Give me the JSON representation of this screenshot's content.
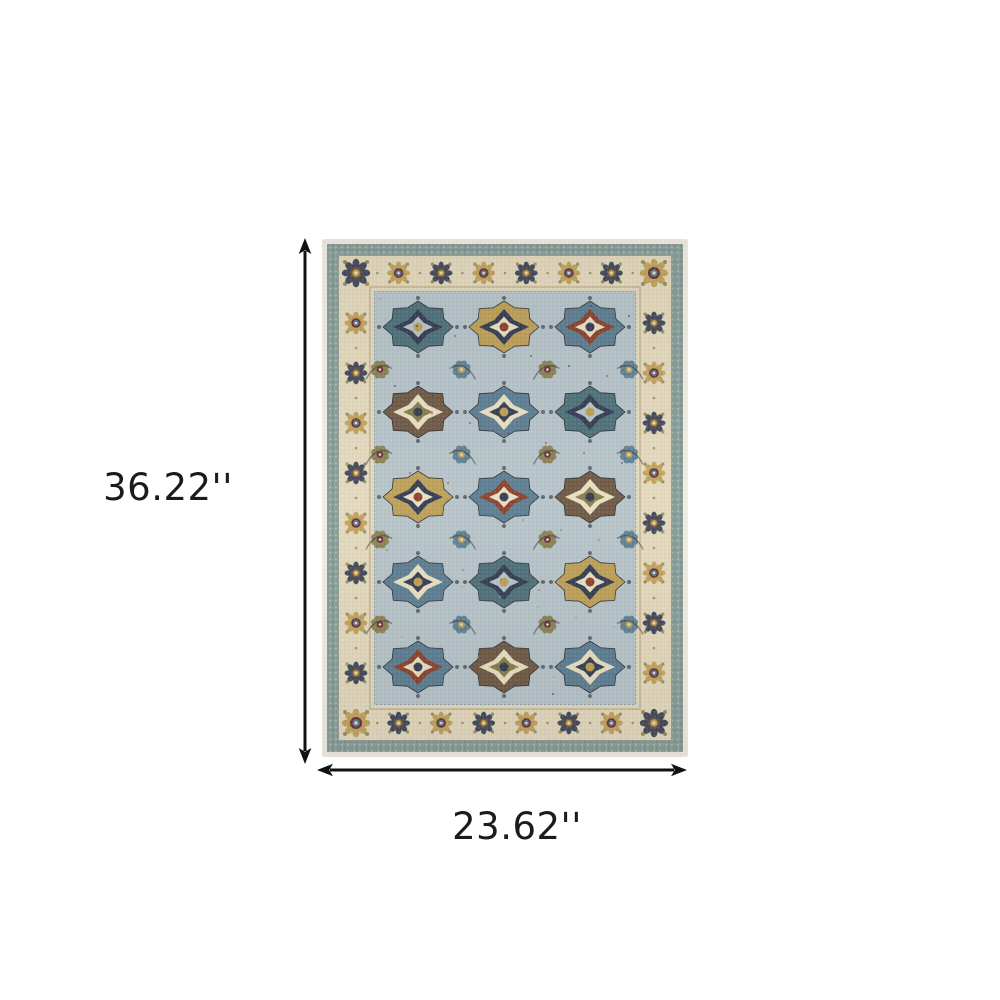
{
  "page": {
    "background": "#ffffff"
  },
  "annotations": {
    "height": {
      "label": "36.22''"
    },
    "width": {
      "label": "23.62''"
    },
    "arrow_color": "#111111",
    "text_color": "#1b1b1b"
  },
  "product_image": {
    "alt": "Blue and beige traditional oriental area rug with medallion pattern",
    "rug": {
      "width_px": 366,
      "height_px": 518,
      "palette": {
        "edge_cream": "#f2eee3",
        "band_teal": "#8ba19c",
        "border_cream": "#e4dabf",
        "guard_gold": "#b3a175",
        "guard_slate": "#73878c",
        "field": "#b8c5ca",
        "navy": "#3a4257",
        "steel_blue": "#5d7e92",
        "teal_motif": "#4e7079",
        "gold": "#c0a157",
        "ochre": "#c98f4e",
        "rust": "#8f4734",
        "maroon": "#6e3440",
        "brown": "#6f5843",
        "olive": "#8a804f",
        "cream_motif": "#e9e0c4",
        "outline": "#2e3138"
      },
      "border_motif_counts": {
        "top": 8,
        "side": 10
      },
      "field_grid": {
        "columns": 3,
        "rows": 5,
        "col_spacing": 86,
        "row_spacing": 85,
        "origin_x": 96,
        "origin_y": 88
      }
    }
  }
}
